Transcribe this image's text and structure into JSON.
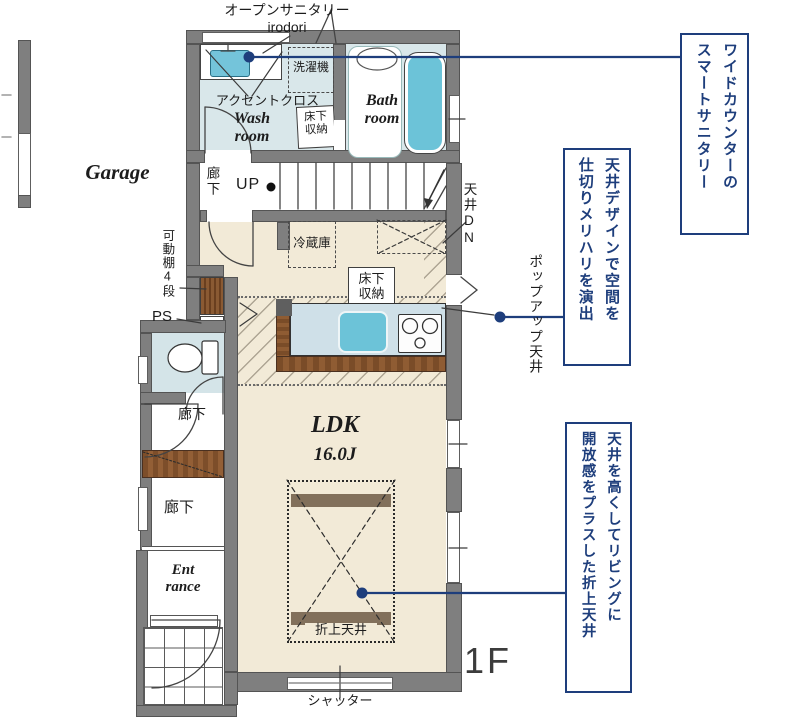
{
  "colors": {
    "navy": "#1e3e7c",
    "wall_gray": "#7f7f7f",
    "floor_cream": "#f2ead7",
    "floor_blue": "#d9e7ea",
    "water_blue": "#6cc3d8",
    "wood_brown": "#7a4c28"
  },
  "top_callout": {
    "jp": "オープンサニタリー",
    "en": "irodori"
  },
  "annotations": [
    {
      "text": "ワイドカウンターの\nスマートサニタリー"
    },
    {
      "text": "天井デザインで空間を\n仕切りメリハリを演出"
    },
    {
      "text": "天井を高くしてリビングに\n開放感をプラスした折上天井"
    }
  ],
  "rooms": {
    "garage": "Garage",
    "wash": "Wash\nroom",
    "bath": "Bath\nroom",
    "ldk": "LDK",
    "ldk_size": "16.0J",
    "entrance": "Ent\nrance",
    "hall_stairs": "廊下",
    "hall_mid": "廊下",
    "hall_lower": "廊下"
  },
  "features": {
    "accent_cloth": "アクセントクロス",
    "washer": "洗濯機",
    "underfloor_wash": "床下\n収納",
    "underfloor_kitchen": "床下\n収納",
    "up": "UP",
    "ceiling_down": "天井DN",
    "fridge": "冷蔵庫",
    "movable_shelf": "可動棚4段",
    "ps": "PS",
    "popup_ceiling": "ポップアップ天井",
    "folded_ceiling": "折上天井",
    "shutter": "シャッター",
    "floor_tag": "1F"
  }
}
